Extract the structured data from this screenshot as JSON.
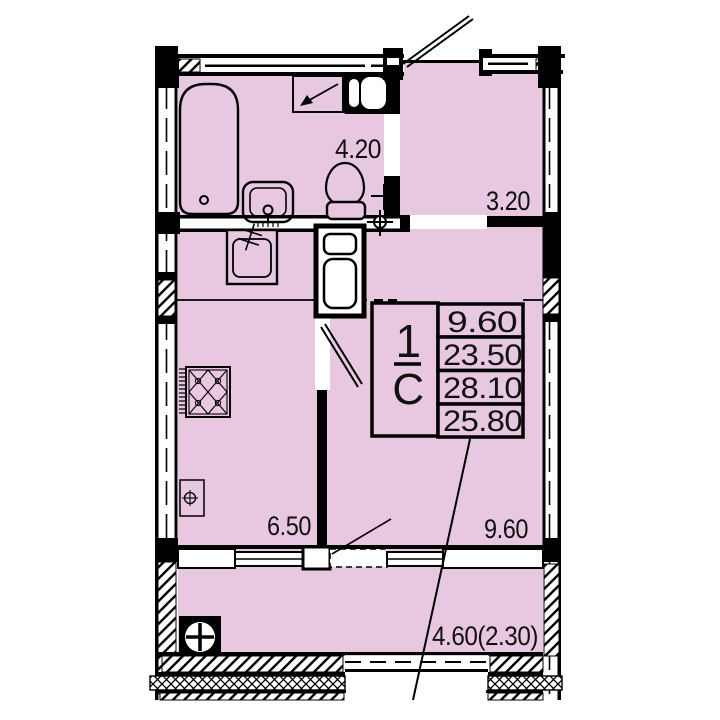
{
  "unit_card": {
    "rooms_count": "1",
    "type_code": "С",
    "areas": [
      "9.60",
      "23.50",
      "28.10",
      "25.80"
    ]
  },
  "room_labels": {
    "bathroom": "4.20",
    "hallway": "3.20",
    "kitchen": "6.50",
    "living_room": "9.60",
    "balcony": "4.60(2.30)"
  },
  "colors": {
    "floor_fill": "#e8c7e1",
    "wall_line": "#000000",
    "background": "#ffffff"
  }
}
